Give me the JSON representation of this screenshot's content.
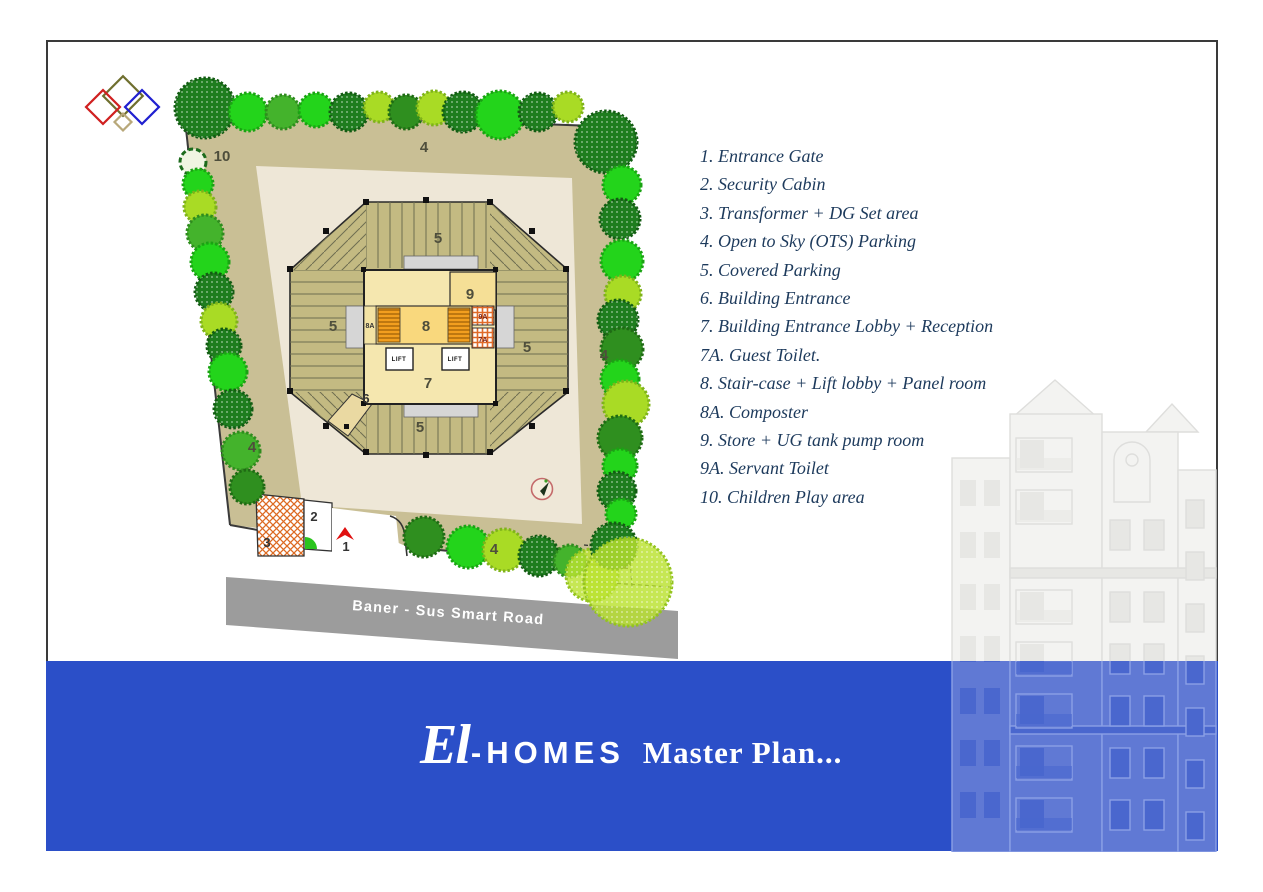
{
  "page": {
    "background": "#ffffff",
    "border_color": "#3a3a3a"
  },
  "logo": {
    "colors": {
      "olive": "#6f6f2f",
      "red": "#d02020",
      "blue": "#2020d0",
      "tan": "#b8a87a"
    }
  },
  "site_plan": {
    "road_label": "Baner - Sus Smart Road",
    "labels": {
      "entrance_gate": "1",
      "security_cabin": "2",
      "transformer": "3",
      "ots_parking": "4",
      "covered_parking": "5",
      "building_entrance": "6",
      "lobby": "7",
      "guest_toilet": "7A",
      "stair_lift": "8",
      "composter": "8A",
      "store": "9",
      "servant_toilet": "9A",
      "children_play": "10",
      "lift": "LIFT"
    },
    "colors": {
      "site_band": "#c9bf95",
      "interior": "#eee7d7",
      "parking_wing": "#c3ba82",
      "core": "#f5e7af",
      "inner_lobby": "#f9d87d",
      "stairs": "#f29f1f",
      "hatch": "#e06a28",
      "road": "#9c9c9c",
      "play_area": "#14a317"
    }
  },
  "legend": {
    "items": [
      "1. Entrance Gate",
      "2. Security Cabin",
      "3. Transformer + DG Set area",
      "4. Open to Sky (OTS) Parking",
      "5. Covered Parking",
      "6. Building Entrance",
      "7. Building Entrance Lobby + Reception",
      "7A. Guest Toilet.",
      "8. Stair-case + Lift lobby + Panel room",
      "8A. Composter",
      "9. Store + UG tank pump room",
      "9A. Servant Toilet",
      "10. Children Play area"
    ]
  },
  "banner": {
    "el": "El",
    "homes": "-HOMES",
    "title": "Master Plan...",
    "background": "#2b4fc8",
    "text_color": "#ffffff"
  }
}
